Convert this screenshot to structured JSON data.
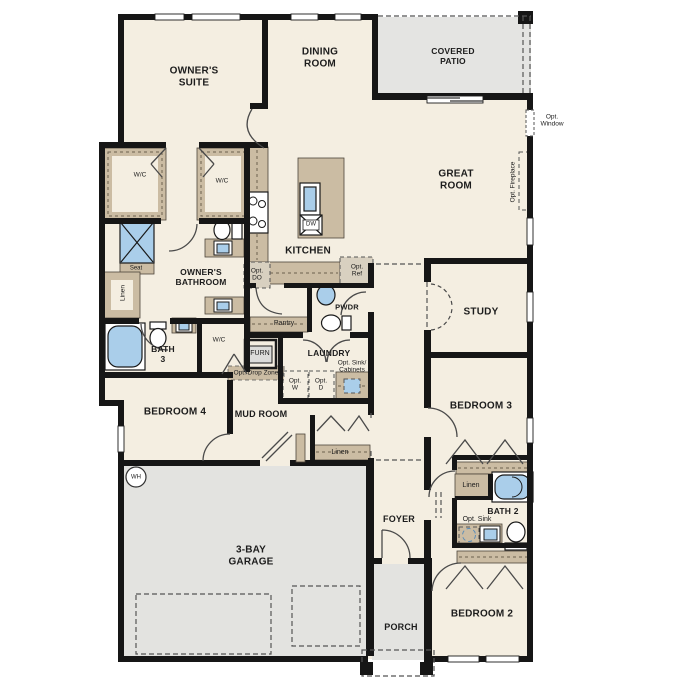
{
  "plan": {
    "title": "single-story floor plan",
    "rooms": {
      "owners_suite": [
        "OWNER'S",
        "SUITE"
      ],
      "dining": [
        "DINING",
        "ROOM"
      ],
      "covered_patio": [
        "COVERED",
        "PATIO"
      ],
      "great_room": [
        "GREAT",
        "ROOM"
      ],
      "kitchen": "KITCHEN",
      "owners_bathroom": [
        "OWNER'S",
        "BATHROOM"
      ],
      "bath3": [
        "BATH",
        "3"
      ],
      "study": "STUDY",
      "laundry": "LAUNDRY",
      "bedroom4": "BEDROOM 4",
      "mud_room": "MUD ROOM",
      "bedroom3": "BEDROOM 3",
      "foyer": "FOYER",
      "bath2": "BATH 2",
      "garage": [
        "3-BAY",
        "GARAGE"
      ],
      "porch": "PORCH",
      "bedroom2": "BEDROOM 2",
      "pwdr": "PWDR",
      "pantry": "Pantry"
    },
    "features": {
      "wic1": "W/C",
      "wic2": "W/C",
      "wic3": "W/C",
      "seat": "Seat",
      "linen_owner": "Linen",
      "linen_hall": "Linen",
      "linen_bath2": "Linen",
      "furn": "FURN",
      "wh": "WH",
      "dw": "DW",
      "opt_do": [
        "Opt.",
        "DO"
      ],
      "opt_ref": [
        "Opt.",
        "Ref"
      ],
      "opt_w": [
        "Opt.",
        "W"
      ],
      "opt_d": [
        "Opt.",
        "D"
      ],
      "opt_drop_zone": "Opt. Drop Zone",
      "opt_sink_cabinets": [
        "Opt. Sink/",
        "Cabinets"
      ],
      "opt_sink_bath2": "Opt. Sink",
      "opt_window": [
        "Opt.",
        "Window"
      ],
      "opt_fireplace": "Opt. Fireplace"
    },
    "colors": {
      "floor": "#f4eee1",
      "hard_surface": "#e3e3e0",
      "wall": "#161616",
      "casework": "#cbbca3",
      "fixture_blue": "#aaceea",
      "hatch_fill": "#d8d0c0"
    }
  }
}
